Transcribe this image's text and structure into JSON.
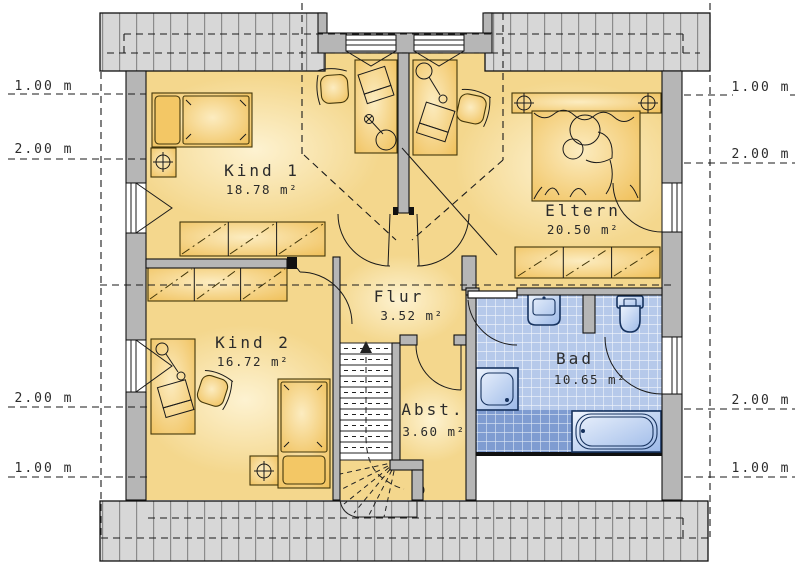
{
  "rooms": {
    "kind1": {
      "name": "Kind 1",
      "area": "18.78 m²"
    },
    "kind2": {
      "name": "Kind 2",
      "area": "16.72 m²"
    },
    "eltern": {
      "name": "Eltern",
      "area": "20.50 m²"
    },
    "flur": {
      "name": "Flur",
      "area": "3.52 m²"
    },
    "abst": {
      "name": "Abst.",
      "area": "3.60 m²"
    },
    "bad": {
      "name": "Bad",
      "area": "10.65 m²"
    }
  },
  "dimensions": {
    "left": [
      {
        "label": "1.00 m"
      },
      {
        "label": "2.00 m"
      },
      {
        "label": "2.00 m"
      },
      {
        "label": "1.00 m"
      }
    ],
    "right": [
      {
        "label": "1.00 m"
      },
      {
        "label": "2.00 m"
      },
      {
        "label": "2.00 m"
      },
      {
        "label": "1.00 m"
      }
    ]
  },
  "colors": {
    "wall": "#b6b6b6",
    "roof": "#d7d7d7",
    "floor": "#f4d78d",
    "furniture": "#f3c765",
    "tile-light": "#b6c9ea",
    "tile-dark": "#7f9cd1",
    "fixture-outline": "#16325e"
  }
}
